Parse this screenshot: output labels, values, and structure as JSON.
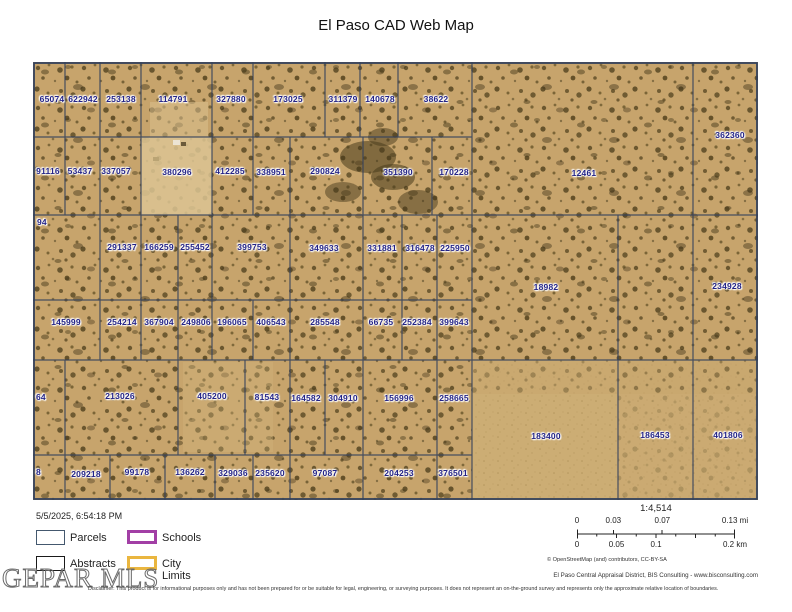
{
  "title": "El Paso CAD Web Map",
  "map": {
    "timestamp": "5/5/2025, 6:54:18 PM",
    "terrain_color": "#c7a46c",
    "boundary_color": "#33415c",
    "label_color": "#232387",
    "parcels": [
      {
        "id": "65074",
        "x": 19,
        "y": 37
      },
      {
        "id": "622942",
        "x": 50,
        "y": 37
      },
      {
        "id": "253138",
        "x": 88,
        "y": 37
      },
      {
        "id": "114791",
        "x": 140,
        "y": 37
      },
      {
        "id": "327880",
        "x": 198,
        "y": 37
      },
      {
        "id": "173025",
        "x": 255,
        "y": 37
      },
      {
        "id": "311379",
        "x": 310,
        "y": 37
      },
      {
        "id": "140678",
        "x": 347,
        "y": 37
      },
      {
        "id": "38622",
        "x": 403,
        "y": 37
      },
      {
        "id": "362360",
        "x": 697,
        "y": 73
      },
      {
        "id": "91116",
        "x": 15,
        "y": 109
      },
      {
        "id": "53437",
        "x": 47,
        "y": 109
      },
      {
        "id": "337057",
        "x": 83,
        "y": 109
      },
      {
        "id": "380296",
        "x": 144,
        "y": 110
      },
      {
        "id": "412285",
        "x": 197,
        "y": 109
      },
      {
        "id": "338951",
        "x": 238,
        "y": 110
      },
      {
        "id": "290824",
        "x": 292,
        "y": 109
      },
      {
        "id": "351390",
        "x": 365,
        "y": 110
      },
      {
        "id": "170228",
        "x": 421,
        "y": 110
      },
      {
        "id": "12461",
        "x": 551,
        "y": 111
      },
      {
        "id": "94",
        "x": 4,
        "y": 160,
        "edge": true
      },
      {
        "id": "291337",
        "x": 89,
        "y": 185
      },
      {
        "id": "166259",
        "x": 126,
        "y": 185
      },
      {
        "id": "255452",
        "x": 162,
        "y": 185
      },
      {
        "id": "399753",
        "x": 219,
        "y": 185
      },
      {
        "id": "349633",
        "x": 291,
        "y": 186
      },
      {
        "id": "331881",
        "x": 349,
        "y": 186
      },
      {
        "id": "316478",
        "x": 387,
        "y": 186
      },
      {
        "id": "225950",
        "x": 422,
        "y": 186
      },
      {
        "id": "18982",
        "x": 513,
        "y": 225
      },
      {
        "id": "234928",
        "x": 694,
        "y": 224
      },
      {
        "id": "145999",
        "x": 33,
        "y": 260
      },
      {
        "id": "254214",
        "x": 89,
        "y": 260
      },
      {
        "id": "367904",
        "x": 126,
        "y": 260
      },
      {
        "id": "249806",
        "x": 163,
        "y": 260
      },
      {
        "id": "196065",
        "x": 199,
        "y": 260
      },
      {
        "id": "406543",
        "x": 238,
        "y": 260
      },
      {
        "id": "285548",
        "x": 292,
        "y": 260
      },
      {
        "id": "66735",
        "x": 348,
        "y": 260
      },
      {
        "id": "252384",
        "x": 384,
        "y": 260
      },
      {
        "id": "399643",
        "x": 421,
        "y": 260
      },
      {
        "id": "64",
        "x": 3,
        "y": 335,
        "edge": true
      },
      {
        "id": "213026",
        "x": 87,
        "y": 334
      },
      {
        "id": "405200",
        "x": 179,
        "y": 334
      },
      {
        "id": "81543",
        "x": 234,
        "y": 335
      },
      {
        "id": "164582",
        "x": 273,
        "y": 336
      },
      {
        "id": "304910",
        "x": 310,
        "y": 336
      },
      {
        "id": "156996",
        "x": 366,
        "y": 336
      },
      {
        "id": "258665",
        "x": 421,
        "y": 336
      },
      {
        "id": "183400",
        "x": 513,
        "y": 374
      },
      {
        "id": "186453",
        "x": 622,
        "y": 373
      },
      {
        "id": "401806",
        "x": 695,
        "y": 373
      },
      {
        "id": "8",
        "x": 3,
        "y": 410,
        "edge": true
      },
      {
        "id": "209218",
        "x": 53,
        "y": 412
      },
      {
        "id": "99178",
        "x": 104,
        "y": 410
      },
      {
        "id": "136262",
        "x": 157,
        "y": 410
      },
      {
        "id": "329036",
        "x": 200,
        "y": 411
      },
      {
        "id": "235620",
        "x": 237,
        "y": 411
      },
      {
        "id": "97087",
        "x": 292,
        "y": 411
      },
      {
        "id": "204253",
        "x": 366,
        "y": 411
      },
      {
        "id": "376501",
        "x": 420,
        "y": 411
      }
    ]
  },
  "legend": {
    "items": [
      {
        "key": "parcels",
        "label": "Parcels",
        "color": "#44586e",
        "border_px": 1.5
      },
      {
        "key": "schools",
        "label": "Schools",
        "color": "#a23fa5",
        "border_px": 3
      },
      {
        "key": "abstracts",
        "label": "Abstracts",
        "color": "#1a1a1a",
        "border_px": 1.5
      },
      {
        "key": "citylimits",
        "label": "City Limits",
        "color": "#eab63f",
        "border_px": 3
      }
    ]
  },
  "scale": {
    "ratio": "1:4,514",
    "mi": [
      {
        "text": "0",
        "pct": 0
      },
      {
        "text": "0.03",
        "pct": 23
      },
      {
        "text": "0.07",
        "pct": 54
      },
      {
        "text": "0.13 mi",
        "pct": 100
      }
    ],
    "km": [
      {
        "text": "0",
        "pct": 0
      },
      {
        "text": "0.05",
        "pct": 25
      },
      {
        "text": "0.1",
        "pct": 50
      },
      {
        "text": "0.2 km",
        "pct": 100
      }
    ],
    "attribution": "© OpenStreetMap (and) contributors, CC-BY-SA"
  },
  "footer": {
    "logo": "GEPAR MLS",
    "credit": "El Paso Central Appraisal District, BIS Consulting - www.bisconsulting.com",
    "disclaimer": "Disclaimer: This product is for informational purposes only and has not been prepared for or be suitable for legal, engineering, or surveying purposes. It does not represent an on-the-ground survey and represents only the approximate relative location of boundaries."
  }
}
